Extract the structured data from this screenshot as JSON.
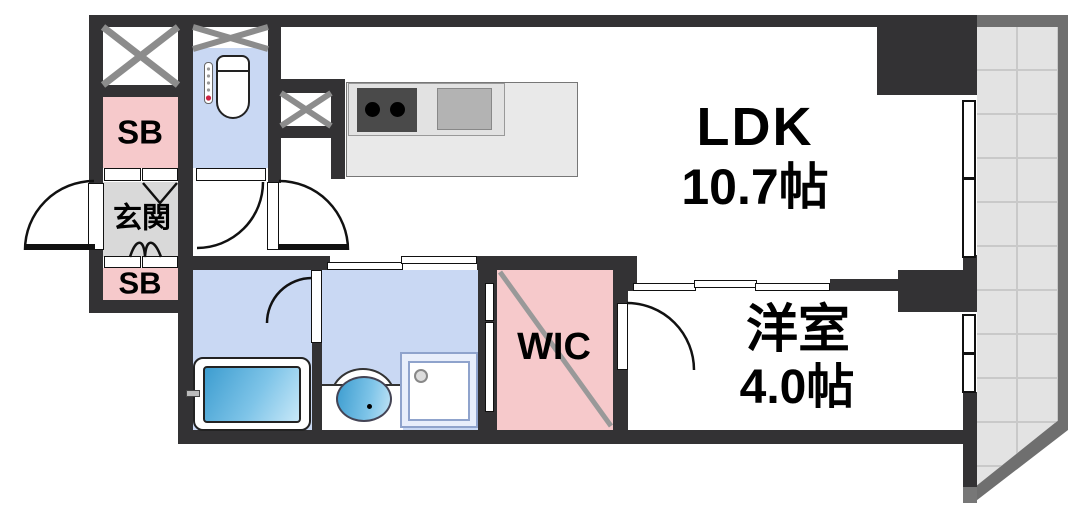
{
  "plan": {
    "rooms": {
      "ldk": {
        "label": "LDK",
        "size": "10.7帖"
      },
      "western_room": {
        "label": "洋室",
        "size": "4.0帖"
      },
      "walk_in_closet": {
        "label": "WIC"
      },
      "entrance": {
        "label": "玄関"
      },
      "shoe_box_upper": {
        "label": "SB"
      },
      "shoe_box_lower": {
        "label": "SB"
      }
    },
    "colors": {
      "wall": "#333234",
      "closet_pink": "#f6c9cb",
      "wet_area_blue": "#c9d8f3",
      "entrance_gray": "#d9d9d9",
      "balcony_tile": "#e3e3e3",
      "balcony_grid": "#c9c9c9",
      "balcony_frame": "#6f6f6f",
      "water_blue": "#3d9dd0"
    }
  }
}
